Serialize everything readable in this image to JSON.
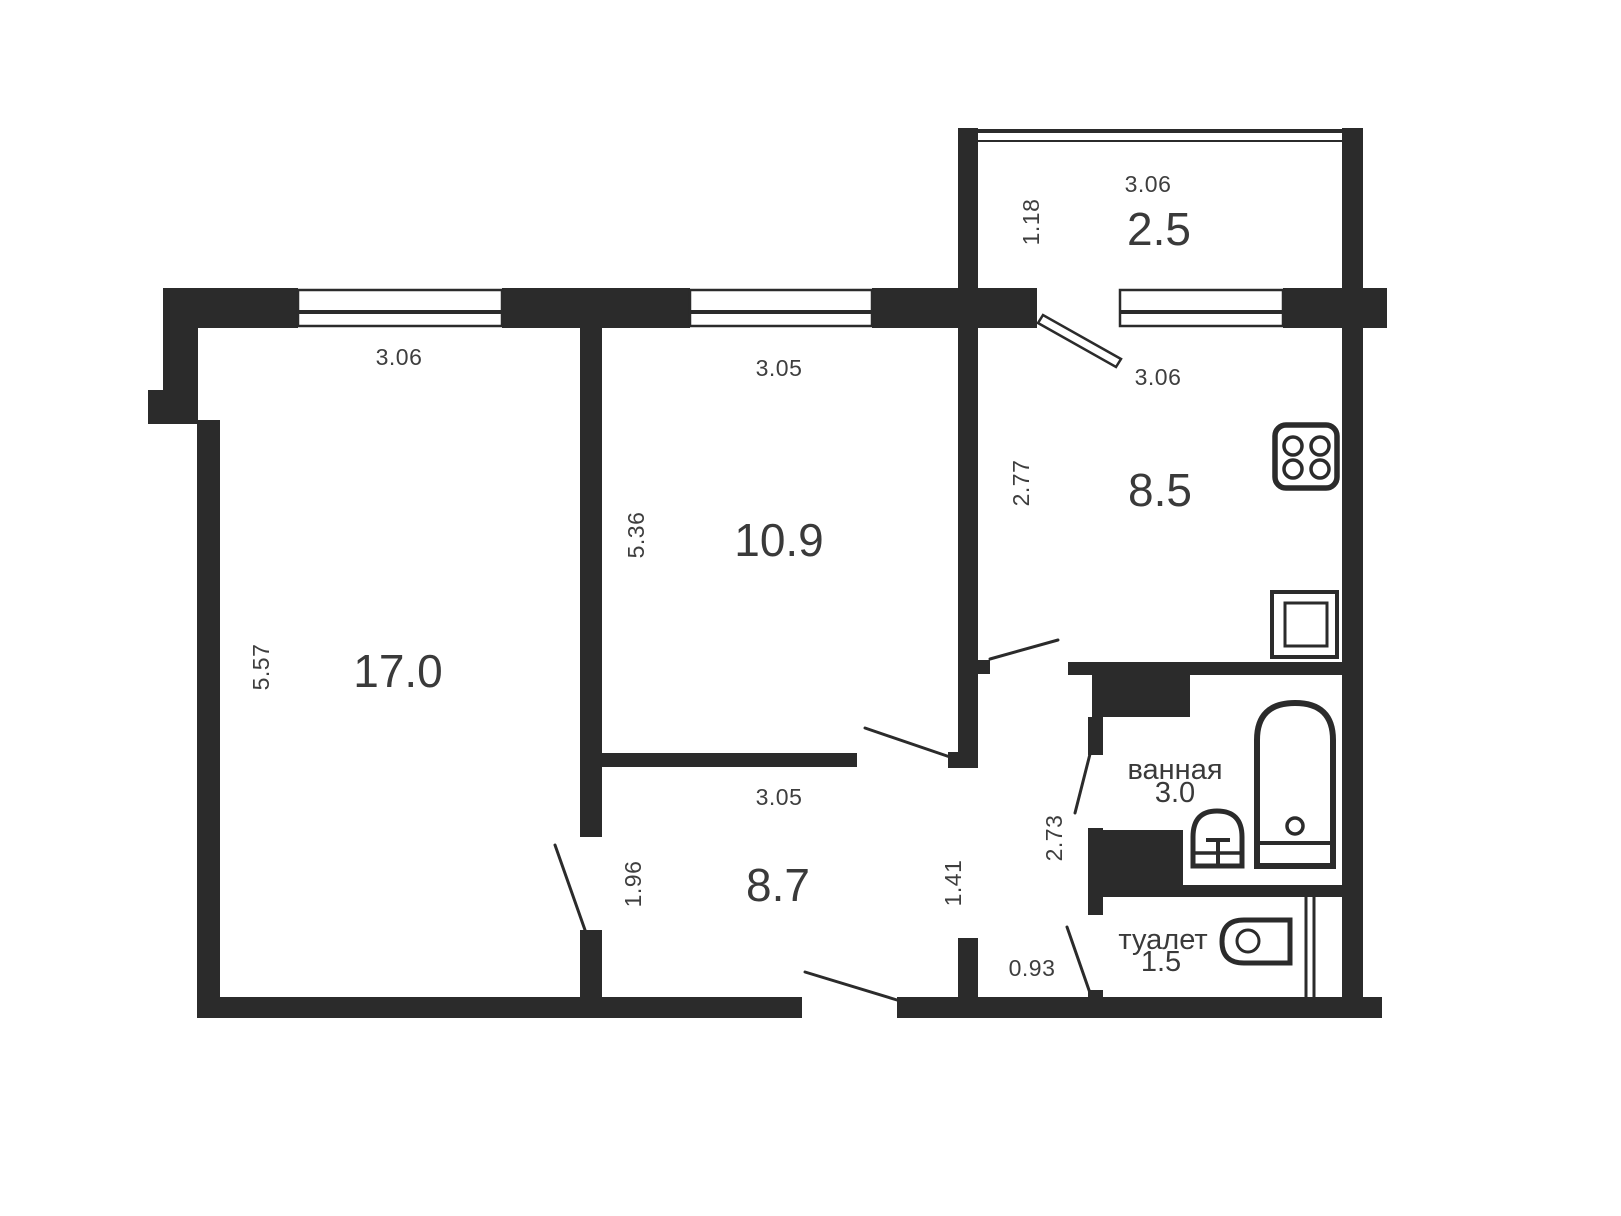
{
  "plan": {
    "type": "apartment-floor-plan",
    "wall_color": "#2b2b2b",
    "text_color": "#3a3a3a",
    "background_color": "#ffffff"
  },
  "rooms": {
    "living": {
      "area": "17.0",
      "dim_top": "3.06",
      "dim_left": "5.57"
    },
    "bedroom": {
      "area": "10.9",
      "dim_top": "3.05",
      "dim_left": "5.36"
    },
    "balcony": {
      "area": "2.5",
      "dim_top": "3.06",
      "dim_left": "1.18"
    },
    "kitchen": {
      "area": "8.5",
      "dim_top": "3.06",
      "dim_left": "2.77"
    },
    "hallway": {
      "area": "8.7",
      "dim_top": "3.05",
      "dim_left": "1.96",
      "dim_right": "1.41"
    },
    "bathroom": {
      "label": "ванная",
      "area": "3.0",
      "dim_left": "2.73"
    },
    "toilet": {
      "label": "туалет",
      "area": "1.5",
      "dim_left": "0.93"
    }
  },
  "fixtures": {
    "stove": "stove-icon",
    "kitchen_sink": "kitchen-sink-icon",
    "bathtub": "bathtub-icon",
    "washbasin": "washbasin-icon",
    "toilet_bowl": "toilet-bowl-icon"
  }
}
